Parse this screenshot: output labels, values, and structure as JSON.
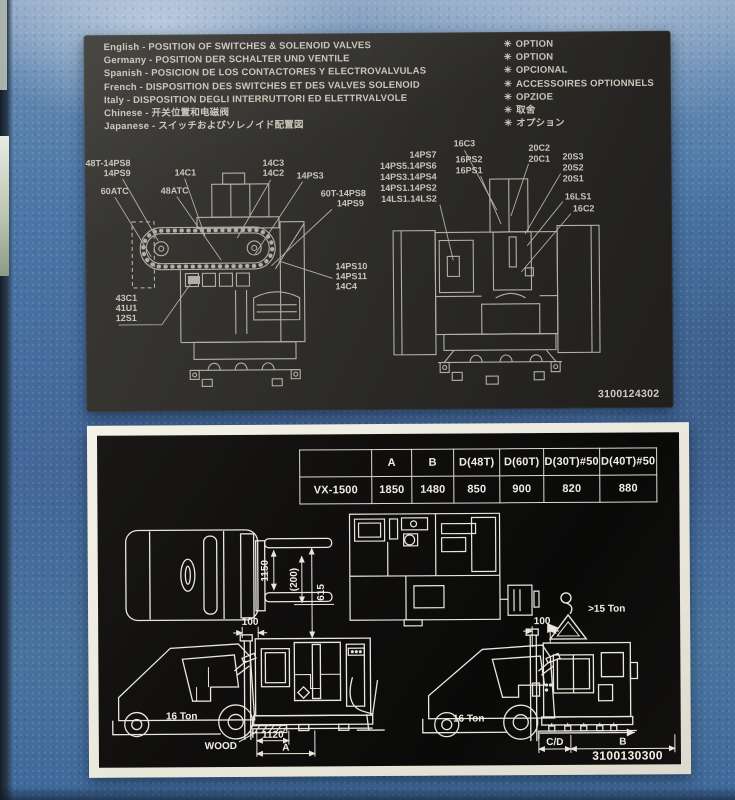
{
  "top_placard": {
    "languages": [
      "English - POSITION OF SWITCHES & SOLENOID VALVES",
      "Germany - POSITION DER SCHALTER UND VENTILE",
      "Spanish - POSICION DE LOS CONTACTORES Y ELECTROVALVULAS",
      "French - DISPOSITION DES SWITCHES ET DES VALVES SOLENOID",
      "Italy - DISPOSITION DEGLI INTERRUTTORI ED ELETTRVALVOLE",
      "Chinese - 开关位置和电磁阀",
      "Japanese - スイッチおよびソレノイド配置図"
    ],
    "option_marker": "✳",
    "options": [
      "OPTION",
      "OPTION",
      "OPCIONAL",
      "ACCESSOIRES OPTIONNELS",
      "OPZIOE",
      "取舍",
      "オプション"
    ],
    "part_number": "3100124302",
    "left_machine_labels": {
      "l1": "48T-14PS8",
      "l2": "14PS9",
      "l3": "14C1",
      "l4": "14C3",
      "l5": "14C2",
      "l6": "14PS3",
      "l7": "60ATC",
      "l8": "48ATC",
      "l9": "60T-14PS8",
      "l10": "14PS9",
      "l11": "14PS10",
      "l12": "14PS11",
      "l13": "14C4",
      "l14": "43C1",
      "l15": "41U1",
      "l16": "12S1"
    },
    "right_machine_labels": {
      "r1": "16C3",
      "r2": "20C2",
      "r3": "20C1",
      "r4": "14PS7",
      "r5": "14PS5.14PS6",
      "r6": "14PS3.14PS4",
      "r7": "14PS1.14PS2",
      "r8": "14LS1.14LS2",
      "r9": "16PS2",
      "r10": "16PS1",
      "r11": "20S3",
      "r12": "20S2",
      "r13": "20S1",
      "r14": "16LS1",
      "r15": "16C2"
    },
    "colors": {
      "plate": "#2a2926",
      "etch": "#c9c5ba"
    }
  },
  "bottom_placard": {
    "table": {
      "headers": [
        "",
        "A",
        "B",
        "D(48T)",
        "D(60T)",
        "D(30T)#50",
        "D(40T)#50"
      ],
      "row_label": "VX-1500",
      "row_values": [
        "1850",
        "1480",
        "850",
        "900",
        "820",
        "880"
      ]
    },
    "labels": {
      "fork_width": "1150",
      "dim_200": "(200)",
      "dim_615": "615",
      "dim_100_left": "100",
      "dim_100_right": "100",
      "ton_left": "16 Ton",
      "ton_right": "16 Ton",
      "crane_capacity": ">15 Ton",
      "wood": "WOOD",
      "dim_1120": "1120",
      "dim_A": "A",
      "dim_CD": "C/D",
      "dim_B": "B"
    },
    "part_number": "3100130300",
    "colors": {
      "plate": "#0a0a09",
      "line": "#e9e7dc",
      "border": "#ece9dc"
    }
  }
}
